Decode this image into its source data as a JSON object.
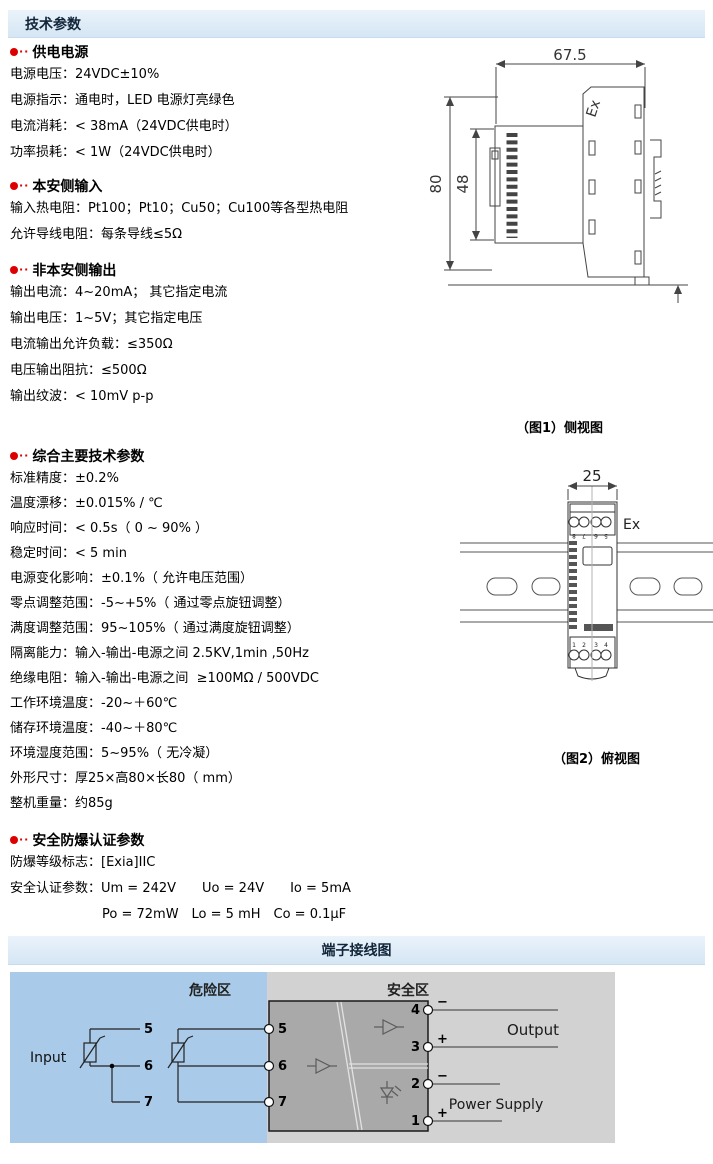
{
  "page": {
    "tech_header": "技术参数",
    "terminal_header": "端子接线图",
    "bullet_dots": "··"
  },
  "colors": {
    "header_bar": "#d9e8f6",
    "bullet_red": "#dd0000",
    "hazard_zone_blue": "#a9cbe9",
    "panel_gray": "#d2d2d2",
    "module_gray": "#a9a9a9"
  },
  "sections": [
    {
      "title": "供电电源",
      "lines": [
        "电源电压：24VDC±10%",
        "电源指示：通电时，LED 电源灯亮绿色",
        "电流消耗：< 38mA（24VDC供电时）",
        "功率损耗：< 1W（24VDC供电时）"
      ]
    },
    {
      "title": "本安侧输入",
      "lines": [
        "输入热电阻：Pt100；Pt10；Cu50；Cu100等各型热电阻",
        "允许导线电阻：每条导线≤5Ω"
      ]
    },
    {
      "title": "非本安侧输出",
      "lines": [
        "输出电流：4~20mA； 其它指定电流",
        "输出电压：1~5V；其它指定电压",
        "电流输出允许负载：≤350Ω",
        "电压输出阻抗：≤500Ω",
        "输出纹波：< 10mV p-p"
      ]
    },
    {
      "title": "综合主要技术参数",
      "lines": [
        "标准精度：±0.2%",
        "温度漂移：±0.015% / ℃",
        "响应时间：< 0.5s（ 0 ~ 90% ）",
        "稳定时间：< 5 min",
        "电源变化影响：±0.1%（ 允许电压范围）",
        "零点调整范围：-5~+5%（ 通过零点旋钮调整）",
        "满度调整范围：95~105%（ 通过满度旋钮调整）",
        "隔离能力：输入-输出-电源之间 2.5KV,1min ,50Hz",
        "绝缘电阻：输入-输出-电源之间  ≥100MΩ / 500VDC",
        "工作环境温度：-20~＋60℃",
        "储存环境温度：-40~＋80℃",
        "环境湿度范围：5~95%（ 无冷凝）",
        "外形尺寸：厚25×高80×长80（ mm）",
        "整机重量：约85g"
      ]
    },
    {
      "title": "安全防爆认证参数",
      "lines": [
        "防爆等级标志：[Exia]IIC",
        "安全认证参数：Um = 242V　　Uo = 24V　　Io = 5mA"
      ],
      "continuation": "Po = 72mW　Lo = 5 mH　Co = 0.1μF"
    }
  ],
  "figure1": {
    "caption": "（图1）侧视图",
    "dim_width": "67.5",
    "dim_height": "80",
    "dim_inner": "48",
    "dim_foot": "3.2",
    "ex_label": "Ex"
  },
  "figure2": {
    "caption": "（图2）俯视图",
    "dim_width": "25",
    "ex_label": "Ex",
    "top_terminals": [
      "8",
      "7",
      "6",
      "5"
    ],
    "bottom_terminals": [
      "1",
      "2",
      "3",
      "4"
    ]
  },
  "wiring": {
    "hazard_label": "危险区",
    "safe_label": "安全区",
    "input_label": "Input",
    "output_label": "Output",
    "power_label": "Power Supply",
    "left_terminals": [
      "5",
      "6",
      "7"
    ],
    "right_terminals": [
      "4",
      "3",
      "2",
      "1"
    ],
    "polarity": [
      "−",
      "+",
      "−",
      "+"
    ]
  }
}
